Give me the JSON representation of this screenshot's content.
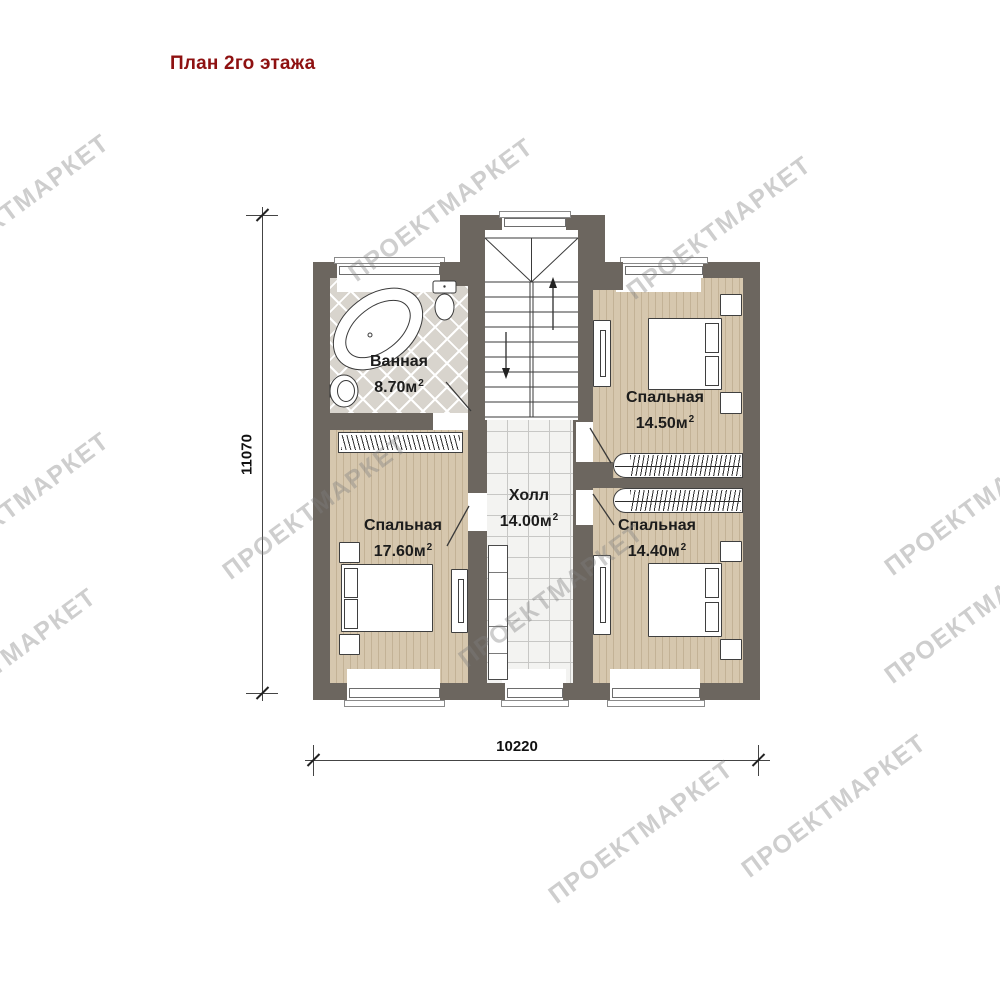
{
  "title": {
    "text": "План 2го этажа"
  },
  "watermark": {
    "text": "ПРОЕКТМАРКЕТ"
  },
  "plan": {
    "rooms": {
      "bathroom": {
        "name": "Ванная",
        "area": "8.70м",
        "sup": "2"
      },
      "bedroom_left": {
        "name": "Спальная",
        "area": "17.60м",
        "sup": "2"
      },
      "bedroom_top_right": {
        "name": "Спальная",
        "area": "14.50м",
        "sup": "2"
      },
      "bedroom_bottom_right": {
        "name": "Спальная",
        "area": "14.40м",
        "sup": "2"
      },
      "hall": {
        "name": "Холл",
        "area": "14.00м",
        "sup": "2"
      }
    },
    "dimensions": {
      "vertical": "11070",
      "horizontal": "10220"
    }
  },
  "colors": {
    "wall": "#6c665f",
    "wood_floor": "#cfc0a6",
    "bath_tile": "#d8d4cd",
    "hall_tile": "#f3f3f1",
    "title": "#8e1111",
    "watermark": "#c9c9c9",
    "line": "#3f3f3f"
  }
}
